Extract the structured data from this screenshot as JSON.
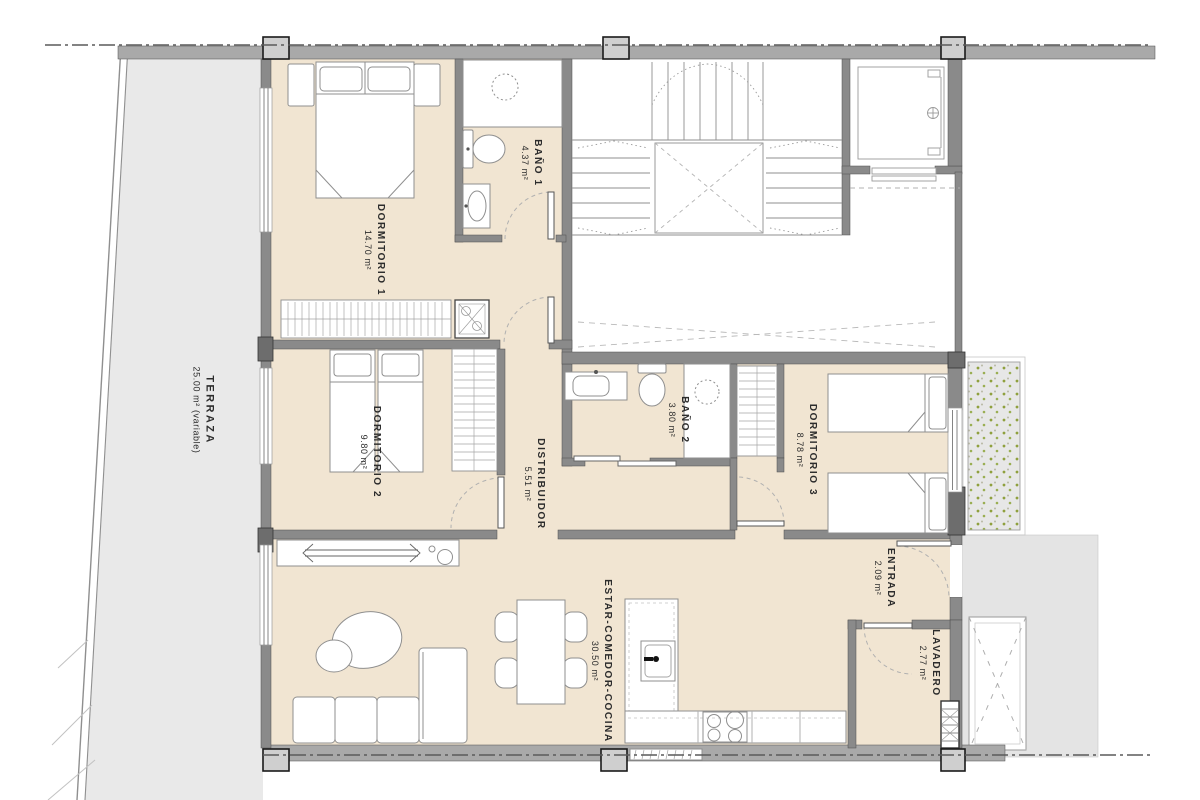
{
  "plan_type": "apartment-floor-plan",
  "rooms": [
    {
      "id": "terraza",
      "name": "TERRAZA",
      "area": "25.00 m² (variable)"
    },
    {
      "id": "dormitorio-1",
      "name": "DORMITORIO 1",
      "area": "14.70 m²"
    },
    {
      "id": "bano-1",
      "name": "BAÑO 1",
      "area": "4.37 m²"
    },
    {
      "id": "dormitorio-2",
      "name": "DORMITORIO 2",
      "area": "9.80 m²"
    },
    {
      "id": "distribuidor",
      "name": "DISTRIBUIDOR",
      "area": "5.51 m²"
    },
    {
      "id": "bano-2",
      "name": "BAÑO 2",
      "area": "3.80 m²"
    },
    {
      "id": "dormitorio-3",
      "name": "DORMITORIO 3",
      "area": "8.78 m²"
    },
    {
      "id": "entrada",
      "name": "ENTRADA",
      "area": "2.09 m²"
    },
    {
      "id": "estar",
      "name": "ESTAR-COMEDOR-COCINA",
      "area": "30.50 m²"
    },
    {
      "id": "lavadero",
      "name": "LAVADERO",
      "area": "2.77 m²"
    }
  ],
  "colors": {
    "floor": "#f1e5d2",
    "wall": "#8a8a8a",
    "band": "#a9a9a9",
    "terrace": "#e9e9e9",
    "exterior": "#e4e4e4",
    "planter_dot": "#8fa03e",
    "text": "#2c2c2c"
  }
}
